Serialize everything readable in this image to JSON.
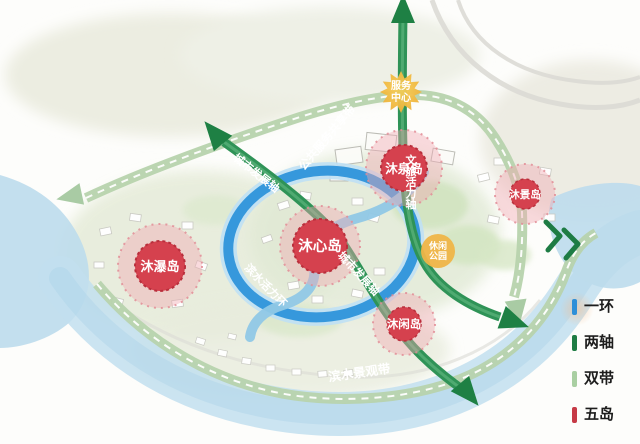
{
  "legend": {
    "items": [
      {
        "label": "一环",
        "color": "#2e8fd8"
      },
      {
        "label": "两轴",
        "color": "#1e7c44"
      },
      {
        "label": "双带",
        "color": "#a9cfa2"
      },
      {
        "label": "五岛",
        "color": "#c63a46"
      }
    ]
  },
  "islands": [
    {
      "name": "沐心岛"
    },
    {
      "name": "沐泉岛"
    },
    {
      "name": "沐景岛"
    },
    {
      "name": "沐瀑岛"
    },
    {
      "name": "沐闲岛"
    }
  ],
  "axes": {
    "north_label": "文旅活力轴",
    "diagonal_label": "城市发展轴"
  },
  "belts": {
    "service_label": "公共服务共享带",
    "waterfront_label": "滨水景观带"
  },
  "ring": {
    "label": "滨水活力环"
  },
  "markers": {
    "service_center": {
      "line1": "服务",
      "line2": "中心"
    },
    "leisure_park": {
      "line1": "休闲",
      "line2": "公园"
    }
  }
}
